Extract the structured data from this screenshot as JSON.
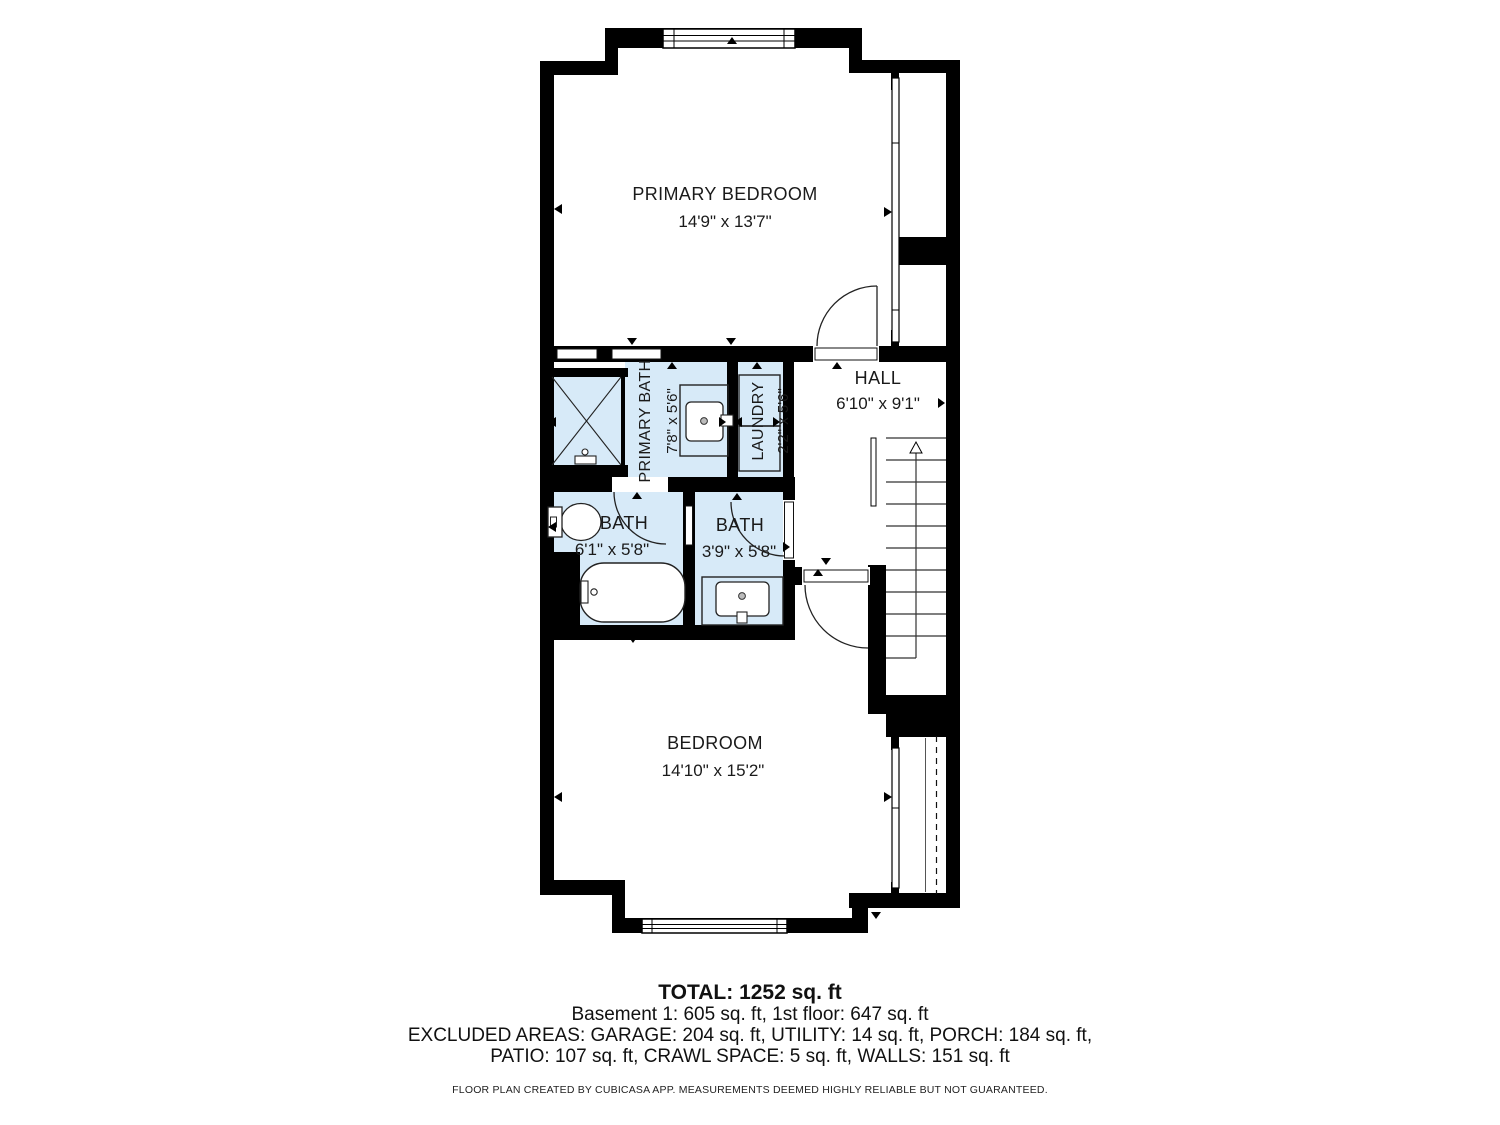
{
  "floor_plan": {
    "rooms": [
      {
        "name": "PRIMARY BEDROOM",
        "dims": "14'9\" x 13'7\""
      },
      {
        "name": "HALL",
        "dims": "6'10\" x 9'1\""
      },
      {
        "name": "PRIMARY BATH",
        "dims": "7'8\" x 5'6\""
      },
      {
        "name": "LAUNDRY",
        "dims": "2'2\" x 5'6\""
      },
      {
        "name": "BATH",
        "dims": "6'1\" x 5'8\""
      },
      {
        "name": "BATH",
        "dims": "3'9\" x 5'8\""
      },
      {
        "name": "BEDROOM",
        "dims": "14'10\" x 15'2\""
      }
    ],
    "colors": {
      "wall": "#000000",
      "wet_room_fill": "#d7eaf8",
      "background": "#ffffff",
      "line": "#222222"
    }
  },
  "summary": {
    "total": "TOTAL: 1252 sq. ft",
    "floors": "Basement 1: 605 sq. ft, 1st floor: 647 sq. ft",
    "excluded_1": "EXCLUDED AREAS: GARAGE: 204 sq. ft, UTILITY: 14 sq. ft, PORCH: 184 sq. ft,",
    "excluded_2": "PATIO: 107 sq. ft, CRAWL SPACE: 5 sq. ft, WALLS: 151 sq. ft",
    "disclaimer": "FLOOR PLAN CREATED BY CUBICASA APP. MEASUREMENTS DEEMED HIGHLY RELIABLE BUT NOT GUARANTEED."
  }
}
